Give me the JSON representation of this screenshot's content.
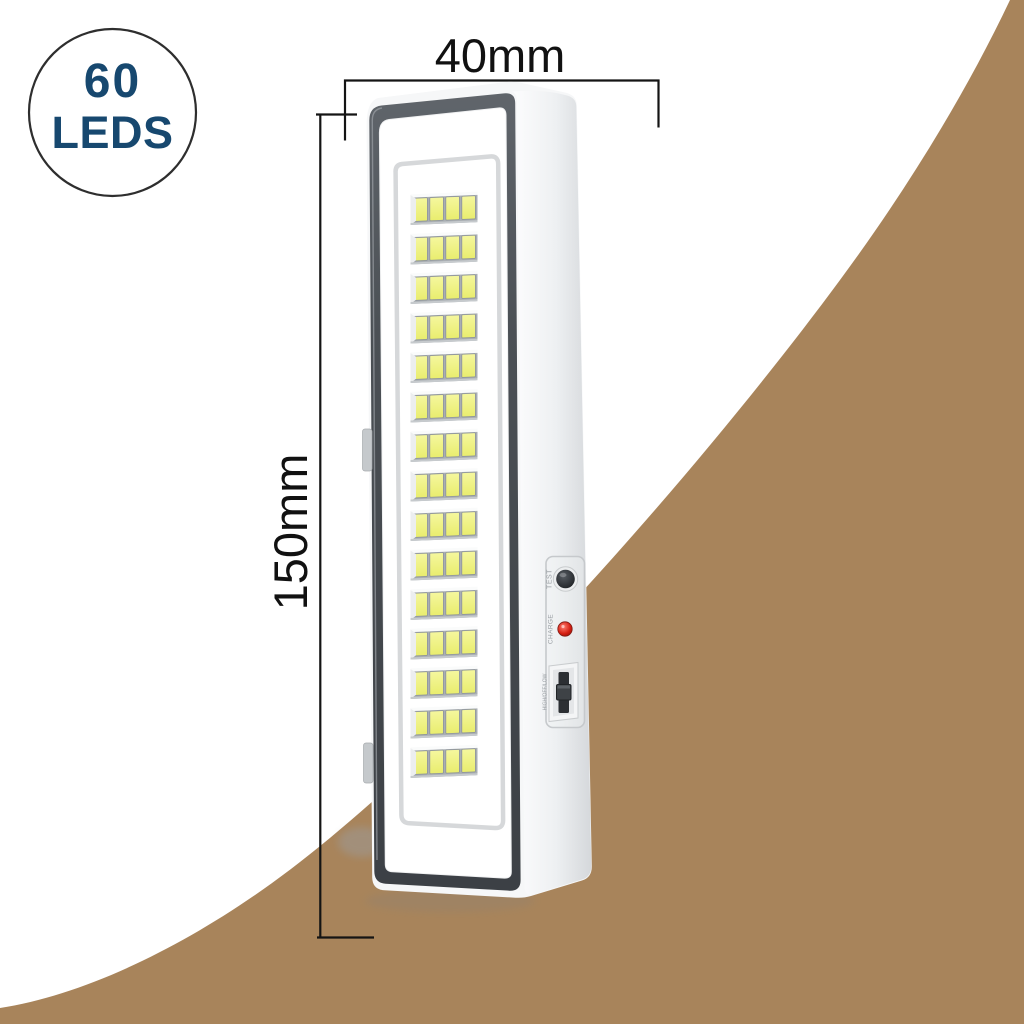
{
  "badge": {
    "value": "60",
    "label": "LEDS",
    "text_color": "#17486f",
    "circle_border_color": "#2e2e2e"
  },
  "dimensions": {
    "width_label": "40mm",
    "height_label": "150mm",
    "line_color": "#141414"
  },
  "device": {
    "type": "rechargeable-emergency-led-light",
    "led_rows": 15,
    "leds_per_row": 4,
    "total_leds": 60,
    "led_color_top": "#f5f79e",
    "led_color_bottom": "#e9ed6e",
    "side_controls": {
      "test_button_label": "TEST",
      "charge_indicator_label": "CHARGE",
      "charge_indicator_color": "#d41e12",
      "mode_switch_label": "HIGH/OFF/LOW"
    }
  },
  "background": {
    "swoosh_color": "#a8845b",
    "page_color": "#ffffff"
  }
}
